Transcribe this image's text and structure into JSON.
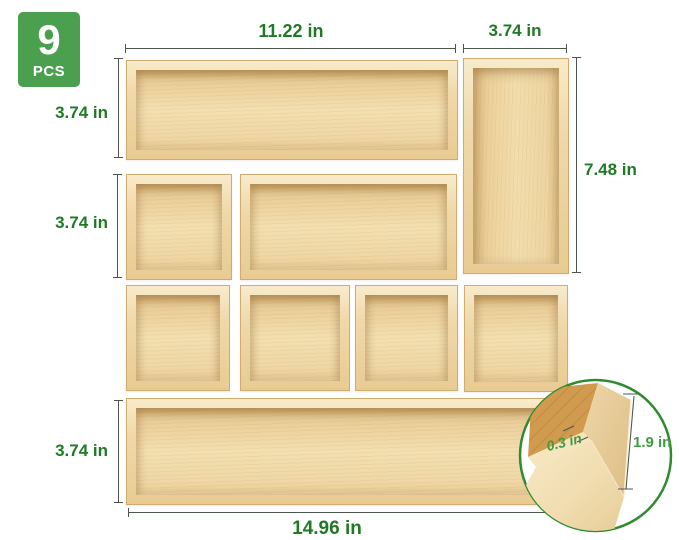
{
  "badge": {
    "count": "9",
    "unit": "PCS"
  },
  "measurements": {
    "top_tray_width": "11.22 in",
    "side_tray_width": "3.74 in",
    "top_tray_height": "3.74 in",
    "side_tray_height": "7.48 in",
    "row2_tray_height": "3.74 in",
    "long_tray_height": "3.74 in",
    "long_tray_width": "14.96 in",
    "wall_thickness": "0.3 in",
    "wall_depth": "1.9 in"
  },
  "colors": {
    "badge_green": "#4aa04e",
    "label_green": "#1e7a24",
    "detail_green": "#3f9b3f",
    "circle_green": "#2e8b2e",
    "line_gray": "#4d564d",
    "bamboo_rim": "#f0d6a2",
    "bamboo_interior": "#eed5a4",
    "bamboo_floor_dark": "#d09b4f"
  }
}
